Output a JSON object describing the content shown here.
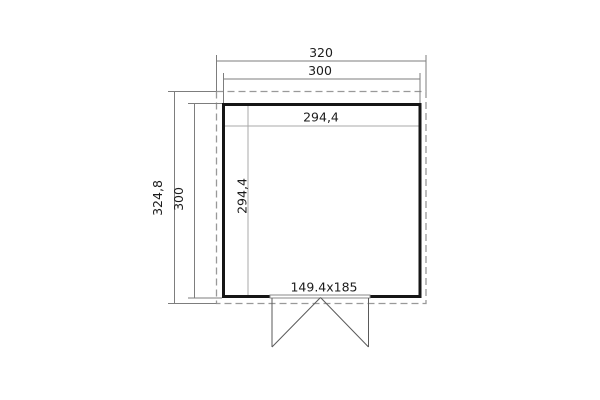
{
  "drawing": {
    "kind": "shed-floor-plan",
    "dims": {
      "roof_width": "320",
      "wall_width": "300",
      "interior_width": "294,4",
      "roof_depth": "324,8",
      "wall_depth": "300",
      "interior_depth": "294,4",
      "door": "149.4x185"
    },
    "colors": {
      "background": "#ffffff",
      "wall": "#161616",
      "dimension_line": "#7d7d7d",
      "interior_line": "#a9a9a9",
      "roof_outline_dashed": "#999999",
      "door_line": "#5a5a5a",
      "text": "#1c1c1c"
    }
  }
}
